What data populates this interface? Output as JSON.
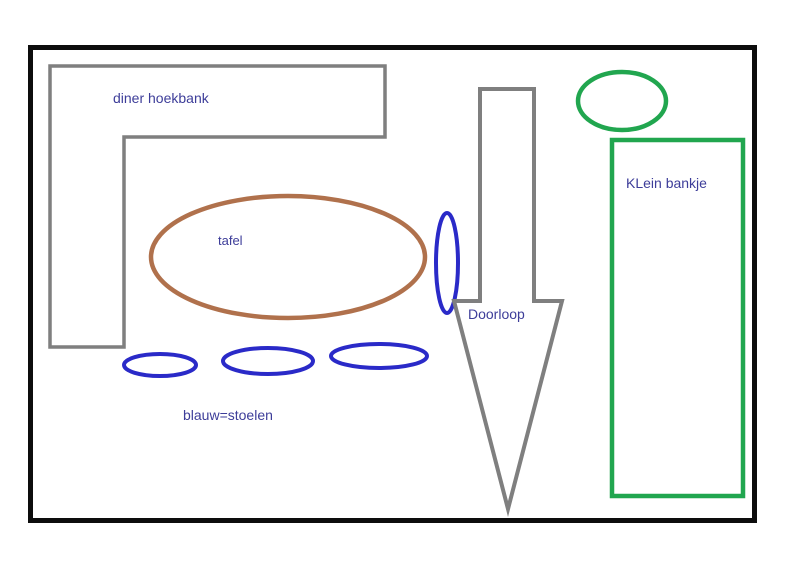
{
  "diagram": {
    "type": "floor-plan-sketch",
    "labels": {
      "corner_bench": "diner hoekbank",
      "table": "tafel",
      "walkway": "Doorloop",
      "small_bench": "KLein bankje",
      "chair_legend": "blauw=stoelen"
    },
    "shapes": [
      {
        "name": "corner-bench-outline",
        "kind": "L-shape outline",
        "color_role": "gray",
        "label": "diner hoekbank"
      },
      {
        "name": "dining-table",
        "kind": "ellipse outline",
        "color_role": "brown",
        "label": "tafel"
      },
      {
        "name": "chair-side",
        "kind": "vertical ellipse outline",
        "color_role": "blue",
        "label": ""
      },
      {
        "name": "chair-1",
        "kind": "horizontal ellipse outline",
        "color_role": "blue",
        "label": ""
      },
      {
        "name": "chair-2",
        "kind": "horizontal ellipse outline",
        "color_role": "blue",
        "label": ""
      },
      {
        "name": "chair-3",
        "kind": "horizontal ellipse outline",
        "color_role": "blue",
        "label": ""
      },
      {
        "name": "walkway-arrow",
        "kind": "downward arrow outline",
        "color_role": "gray",
        "label": "Doorloop"
      },
      {
        "name": "small-bench-top",
        "kind": "ellipse outline",
        "color_role": "green",
        "label": ""
      },
      {
        "name": "small-bench",
        "kind": "rectangle outline",
        "color_role": "green",
        "label": "KLein bankje"
      }
    ]
  },
  "colors": {
    "page": "#ffffff",
    "frame": "#0d0d0d",
    "gray": "#7f7f7f",
    "brown": "#b0714c",
    "blue": "#2a2ac8",
    "green": "#21a64f",
    "label": "#3d3d99"
  }
}
